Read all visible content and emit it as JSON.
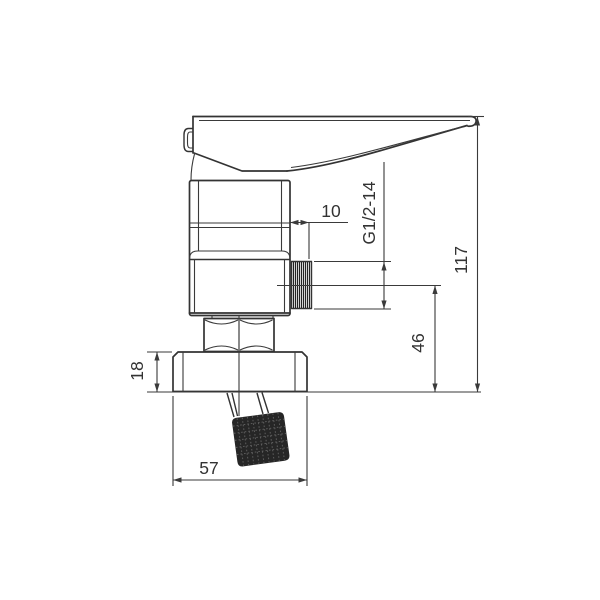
{
  "drawing": {
    "subject": "single-lever shower mixer valve, side elevation",
    "line_color": "#333333",
    "background_color": "#ffffff",
    "dimensions": {
      "outlet_length": "10",
      "outlet_thread": "G1/2-14",
      "overall_height": "117",
      "outlet_center_to_base": "46",
      "flange_thickness": "18",
      "flange_width": "57"
    }
  }
}
